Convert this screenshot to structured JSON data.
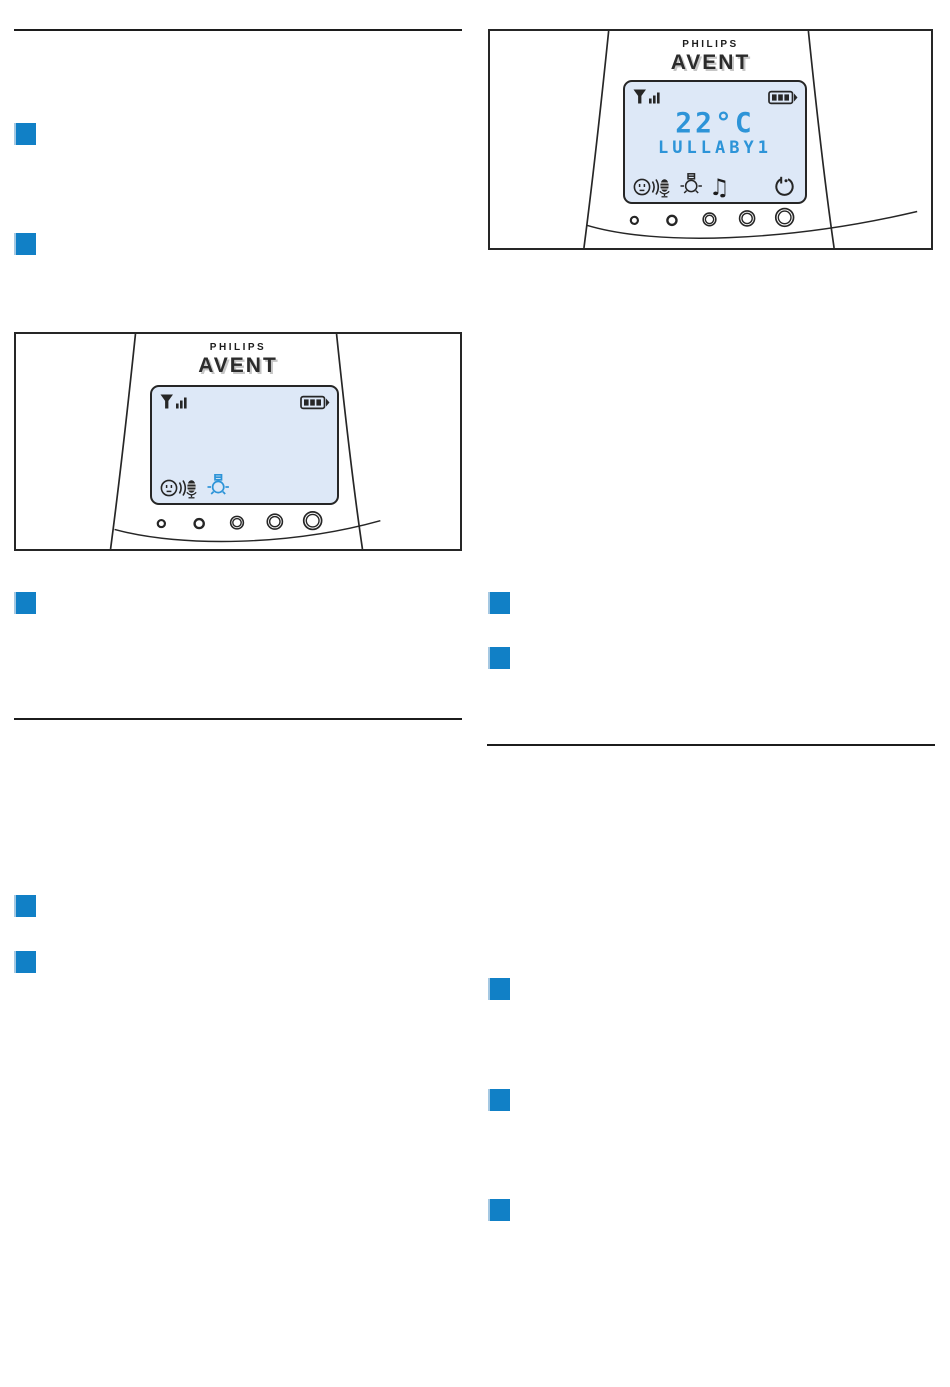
{
  "colors": {
    "accent": "#1180c6",
    "marker_edge": "#a5c8e2",
    "lcd_blue": "#2d94d8",
    "screen_bg": "#dde8f7",
    "line_art": "#262626"
  },
  "brand": {
    "philips": "PHILIPS",
    "avent": "AVENT"
  },
  "figure_right": {
    "caption": "parent unit display showing temperature and lullaby",
    "display": {
      "temperature": "22°C",
      "lullaby_label": "LULLABY1",
      "note_glyph": "♫",
      "status_icons": [
        "signal-strength-icon",
        "battery-full-icon"
      ],
      "function_icons": [
        "talk-back-icon",
        "nightlight-icon",
        "lullaby-note-icon",
        "power-timer-icon"
      ]
    },
    "buttons_count": 5
  },
  "figure_left": {
    "caption": "parent unit display with nightlight icon lit",
    "display": {
      "status_icons": [
        "signal-strength-icon",
        "battery-full-icon"
      ],
      "function_icons": [
        "talk-back-icon",
        "nightlight-icon-active"
      ]
    },
    "buttons_count": 5
  },
  "step_markers": {
    "left_column_count": 5,
    "right_column_count": 5
  }
}
